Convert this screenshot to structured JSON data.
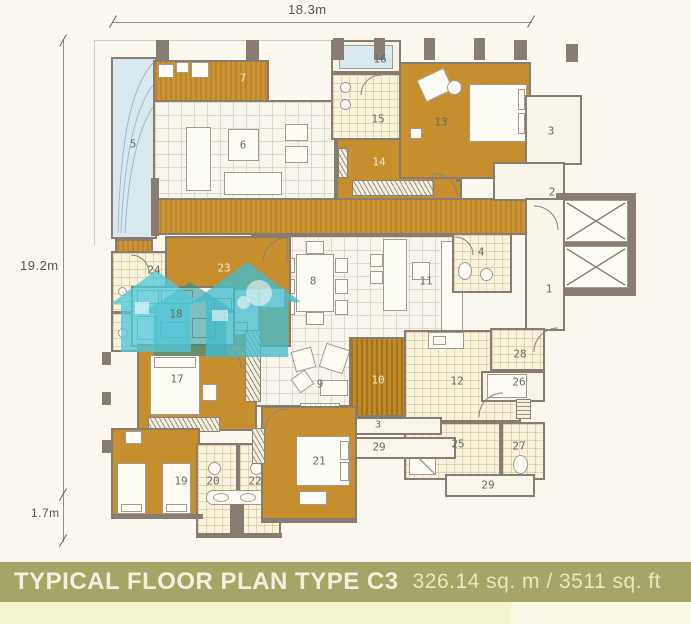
{
  "banner": {
    "title": "TYPICAL FLOOR PLAN TYPE C3",
    "area": "326.14 sq. m / 3511 sq. ft"
  },
  "dimensions": {
    "top": "18.3m",
    "left": "19.2m",
    "left_small": "1.7m"
  },
  "room_labels": {
    "r1": "1",
    "r2": "2",
    "r3": "3",
    "r3_ledge": "3",
    "r4": "4",
    "r5": "5",
    "r6": "6",
    "r7": "7",
    "r8": "8",
    "r9": "9",
    "r10": "10",
    "r11": "11",
    "r12": "12",
    "r13": "13",
    "r14": "14",
    "r15": "15",
    "r16": "16",
    "r17": "17",
    "r18": "18",
    "r19": "19",
    "r20": "20",
    "r21": "21",
    "r22": "22",
    "r23": "23",
    "r24": "24",
    "r25": "25",
    "r26": "26",
    "r27": "27",
    "r28": "28",
    "r29_upper": "29",
    "r29_lower": "29"
  },
  "colors": {
    "banner_bg": "#a5a567",
    "room_gold": "#c68e2d",
    "tile_cream": "#f8f3dd",
    "pool_blue": "#d9e9ef",
    "wall_gray": "#877d72",
    "watermark_teal": "#42bcce"
  }
}
